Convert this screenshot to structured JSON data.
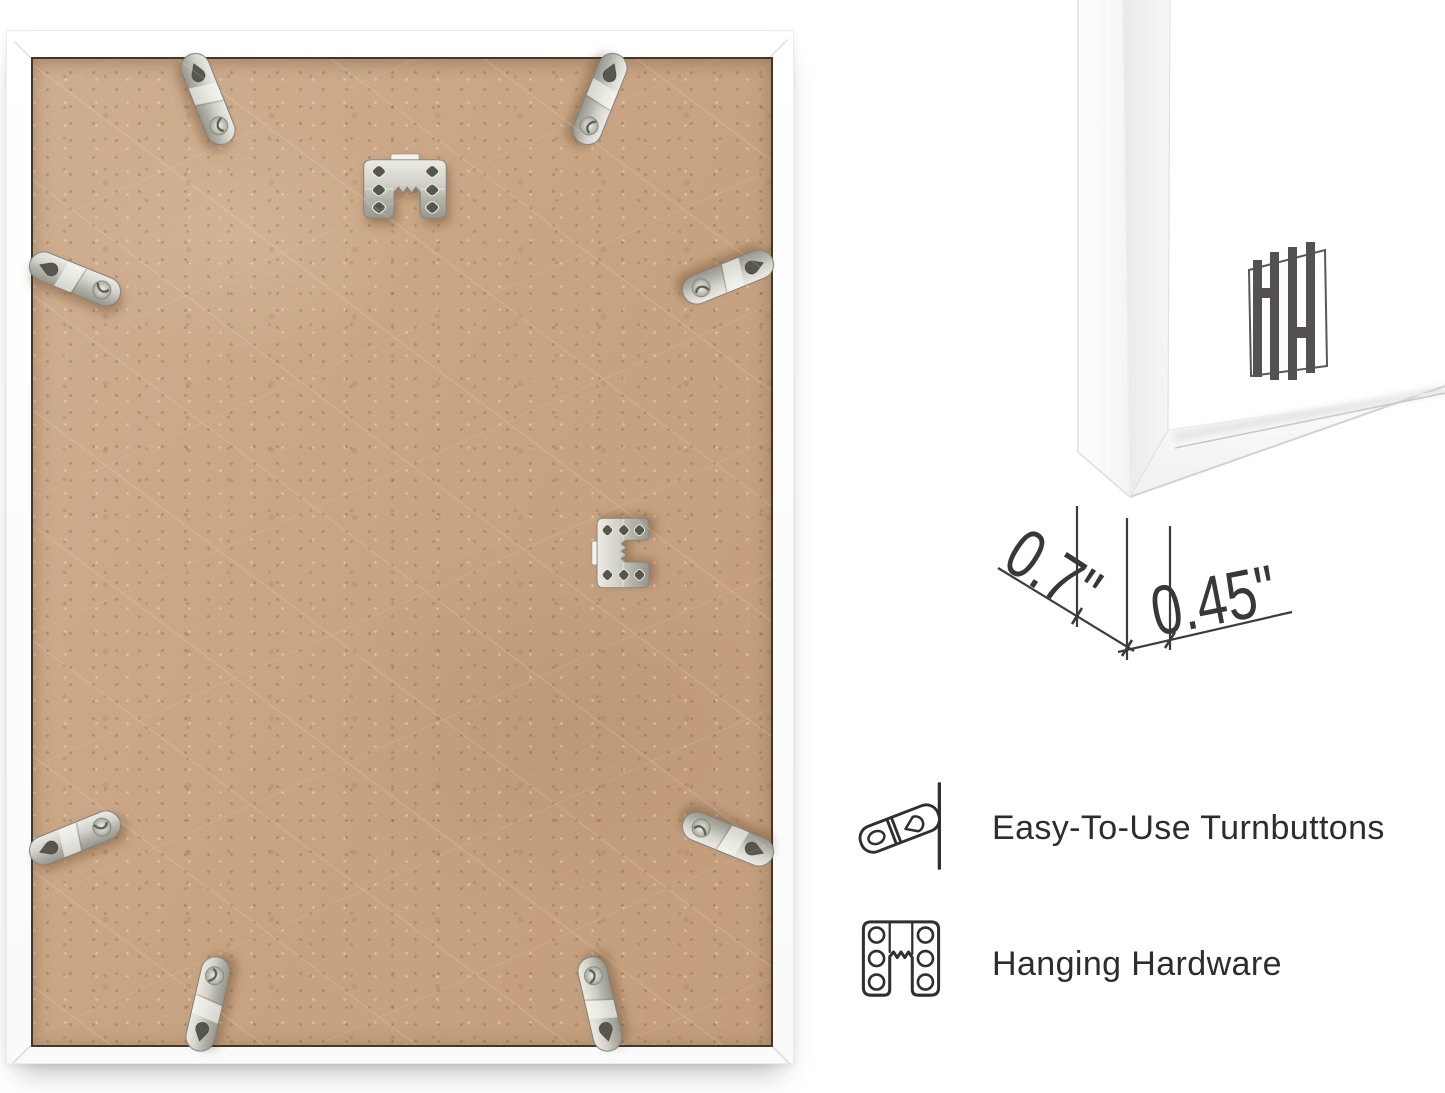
{
  "photo": {
    "frame_color": "#ffffff",
    "board_color": "#c9a584",
    "seam_color": "#42372b",
    "metal_color": "#c2c2b8",
    "turnbutton_count": 8,
    "sawtooth_hanger_count": 2
  },
  "corner_detail": {
    "frame_color": "#ffffff",
    "logo_mark": "HH",
    "logo_color": "#555150",
    "line_color": "#3c3c3c",
    "dimensions": {
      "depth": "0.7\"",
      "face_width": "0.45\""
    }
  },
  "features": {
    "text_color": "#2d2d2d",
    "items": [
      {
        "icon": "turnbutton-icon",
        "label": "Easy-To-Use Turnbuttons"
      },
      {
        "icon": "hanging-hardware-icon",
        "label": "Hanging Hardware"
      }
    ]
  }
}
